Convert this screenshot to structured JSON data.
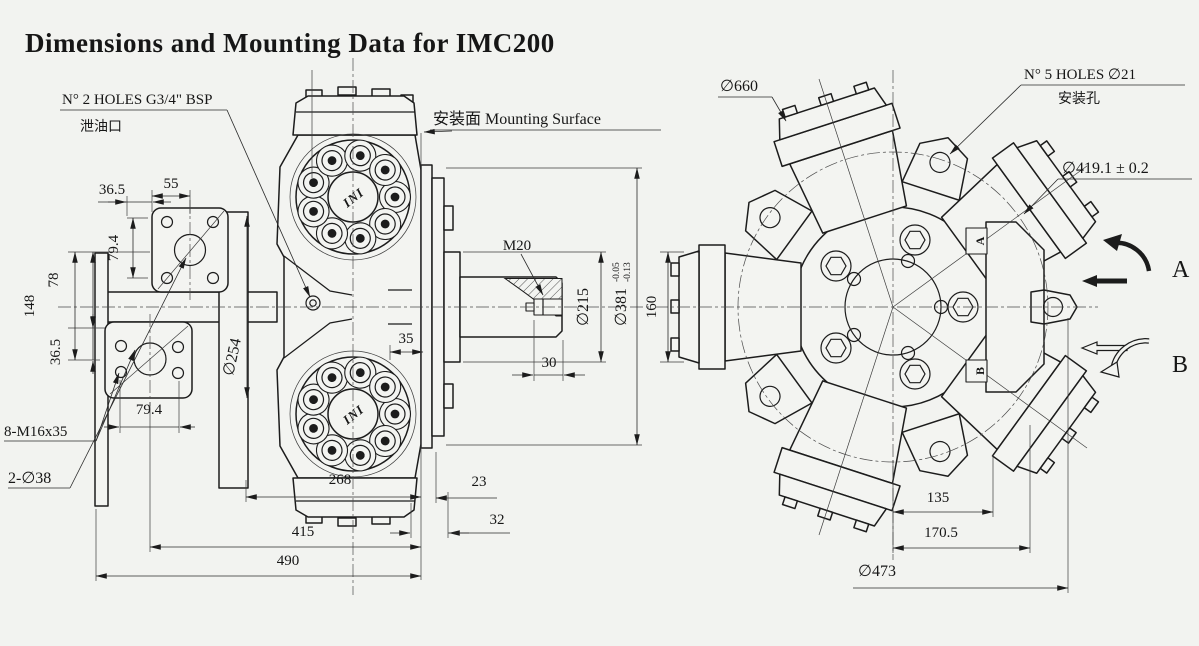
{
  "colors": {
    "background": "#f2f3f0",
    "line": "#1c1c1c"
  },
  "title": "Dimensions and Mounting Data for IMC200",
  "left_view": {
    "logo": "INI",
    "callout_bsp": "N° 2 HOLES G3/4\" BSP",
    "callout_bsp_cn": "泄油口",
    "callout_mounting": "安装面 Mounting Surface",
    "callout_bolts": "8-M16x35",
    "callout_holes": "2-∅38",
    "callout_thread": "M20",
    "dim_36_5_top": "36.5",
    "dim_55": "55",
    "dim_79_4_side": "79.4",
    "dim_78": "78",
    "dim_148": "148",
    "dim_36_5_side": "36.5",
    "dim_79_4_bottom": "79.4",
    "dim_254": "∅254",
    "dim_35": "35",
    "dim_30": "30",
    "dim_215": "∅215",
    "dim_381": "∅381",
    "dim_381_tol_top": "-0.05",
    "dim_381_tol_bottom": "-0.13",
    "dim_268": "268",
    "dim_23": "23",
    "dim_415": "415",
    "dim_32": "32",
    "dim_490": "490"
  },
  "right_view": {
    "callout_660": "∅660",
    "callout_holes": "N° 5 HOLES ∅21",
    "callout_holes_cn": "安装孔",
    "callout_419": "∅419.1 ± 0.2",
    "dim_160": "160",
    "dim_135": "135",
    "dim_170_5": "170.5",
    "dim_473": "∅473",
    "port_a": "A",
    "port_b": "B",
    "rot_a": "A",
    "rot_b": "B"
  }
}
